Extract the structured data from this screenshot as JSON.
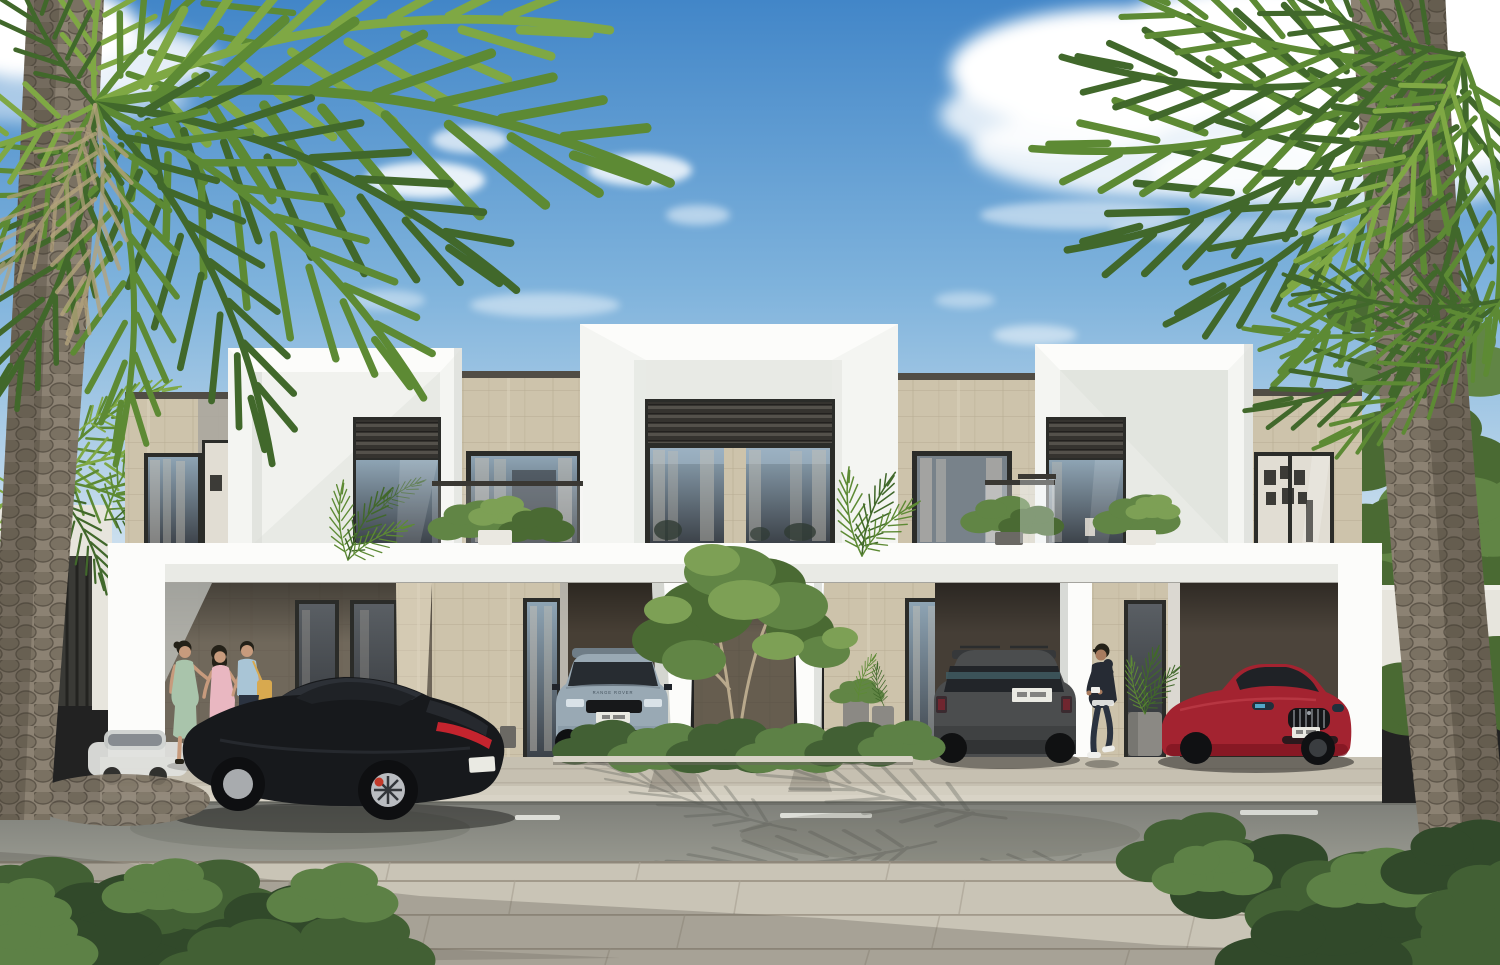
{
  "scene": {
    "description": "Photorealistic daytime architectural rendering of a contemporary two-storey townhouse row: white picture-frame facades with beige travertine stone cladding, dark aluminium louvers over tall windows, roof terraces with glass balustrades and potted plants, covered carports with parked cars, tall date palms left and right, ornamental grasses and shrubs, and a grey asphalt street with white dashed markings in front of a stone-paved foreground walkway under a blue sky with scattered white clouds.",
    "sky": {
      "condition": "sunny, blue sky with scattered white clouds"
    },
    "architecture": {
      "style": "contemporary minimalist townhouse row",
      "storeys": 2,
      "materials": [
        "white render",
        "beige travertine stone",
        "dark aluminium louvers",
        "floor-to-ceiling glazing"
      ],
      "features": [
        "deep picture-frame facade volumes",
        "roof terraces with glass balustrades",
        "covered carports",
        "potted plants by entrances",
        "interior gallery wall visible in right window"
      ]
    },
    "vehicles": [
      {
        "id": "black-sports-coupe",
        "description": "black sports coupe driving past on the street",
        "plate": "white plate, characters not legible",
        "hood_text": ""
      },
      {
        "id": "light-blue-compact-suv",
        "description": "light blue-grey compact SUV parked in left carport",
        "plate": "white plate, characters not legible",
        "hood_text": "RANGE ROVER"
      },
      {
        "id": "dark-grey-suv",
        "description": "dark grey SUV parked in centre-right carport, seen from rear",
        "plate": "white plate, characters not legible",
        "hood_text": ""
      },
      {
        "id": "red-luxury-sedan",
        "description": "red luxury sedan with chrome grille parked in right carport",
        "plate": "white plate, characters not legible",
        "hood_text": ""
      }
    ],
    "people": [
      {
        "id": "woman-green-dress",
        "description": "woman in sage-green dress chatting on the left walkway"
      },
      {
        "id": "woman-pink-dress",
        "description": "woman in pink dress chatting on the left walkway"
      },
      {
        "id": "man-blue-shirt",
        "description": "man in light blue shirt with tan shoulder bag on the left walkway"
      },
      {
        "id": "man-dark-hoodie",
        "description": "man in dark hoodie, joggers and white sneakers walking by the right carport"
      }
    ],
    "vegetation": [
      "tall date palms framing the scene left and right",
      "wheat-coloured ornamental grasses",
      "clipped green shrubs and hedges",
      "small multi-stem tree in the centre planter",
      "potted plants on terraces and beside doors"
    ],
    "street": {
      "road": "grey asphalt with white dashed lane markings and palm-frond shadows",
      "kerb": "light concrete kerb",
      "foreground": "large-format stone pavers with soft shadow band"
    }
  },
  "colors": {
    "sky_top": "#4286c8",
    "sky_mid": "#7fb3dc",
    "sky_low": "#c3daec",
    "sky_horizon": "#e2edf4",
    "cloud": "#ffffff",
    "stone": "#cdc3ab",
    "stone_line": "#b7ac93",
    "stone_lit": "#dcd3bd",
    "stone_shadow": "#776e60",
    "stone_shadow_line": "#665e51",
    "coping": "#514d45",
    "white_face": "#f4f5f2",
    "white_bright": "#fcfcfa",
    "white_shade": "#d9dcd7",
    "white_recess": "#e8eae5",
    "frame_dark": "#2b2c29",
    "louver_dark": "#35332f",
    "louver_lit": "#54514b",
    "glass_top": "#8ea4b4",
    "glass_bottom": "#3c4249",
    "glass_door_top": "#5a5f64",
    "glass_door_bottom": "#2d3034",
    "curtain": "#c6c0b5",
    "interior_wall": "#e1ddd3",
    "picture_frame": "#3c3b37",
    "slab_shadow": "#3f3b35",
    "bg_wall": "#e7e5dd",
    "gate_dark": "#3a3a36",
    "gate_gap": "#232320",
    "road_top": "#7f807a",
    "road_bottom": "#97988f",
    "road_mark": "#ecede8",
    "curb": "#d8d3c6",
    "pave": "#c9c4b6",
    "pave_line": "#a29a8b",
    "ground": "#c6c0b1",
    "ground_line": "#a9a294",
    "shadow": "#4e4a43",
    "frond_light": "#7fa844",
    "frond_mid": "#5d8a34",
    "frond_dark": "#41682b",
    "frond_shadow": "#565851",
    "dead_frond": "#b3a27c",
    "trunk": "#8c8273",
    "trunk_knob": "#7a7162",
    "trunk_knob_line": "#5e564a",
    "trunk_shade": "#3e382f",
    "trunk_light": "#b6ac99",
    "tree_dark": "#4a6a33",
    "tree_mid": "#618545",
    "tree_light": "#7da055",
    "bush_dark": "#31492a",
    "bush_mid": "#426034",
    "bush_light": "#5d8146",
    "wheat": "#c9b990",
    "wheat_plume": "#e2d7b8",
    "rust": "#a06b4a",
    "rust_plume": "#bd8d68",
    "grass_green": "#76884f",
    "grass_green_light": "#95a768",
    "pot": "#8b8984",
    "pot_dark": "#6b6964",
    "pot_white": "#eae8e1",
    "car_black": "#17191c",
    "car_black_hi": "#41474f",
    "car_glass": "#1f2226",
    "tail_red": "#c4242e",
    "caliper_red": "#c33a2a",
    "rim_silver": "#b9bcc0",
    "evoque_body": "#99a9b4",
    "evoque_roof": "#6f7d87",
    "suv_body": "#4b4d4e",
    "suv_dark": "#36383a",
    "suv_reflect": "#3f5a60",
    "maserati_red": "#a32330",
    "maserati_dark": "#7a1420",
    "maserati_hi": "#c4434e",
    "chrome": "#9aa0a6",
    "headlight_blue": "#58b5d8",
    "plate": "#eaeae3",
    "skin": "#c79b7d",
    "skin_dark": "#a87b5e",
    "hair": "#242118",
    "dress_green": "#a9c4ab",
    "dress_pink": "#e9b7c1",
    "shirt_blue": "#a9c5d6",
    "pants_navy": "#2b3340",
    "hoodie": "#262b34",
    "bag_tan": "#d8a94f",
    "shoe_white": "#efefec",
    "white_car": "#e0e1de"
  }
}
